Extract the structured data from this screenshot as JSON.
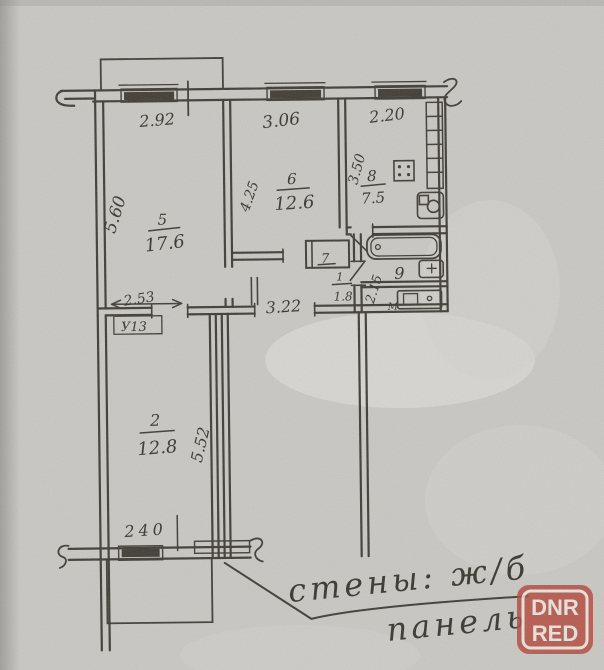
{
  "plan": {
    "dims": {
      "window_left": "2.92",
      "window_middle": "3.06",
      "window_kitchen": "2.20",
      "room5_depth": "5.60",
      "room6_depth": "4.25",
      "kitchen_depth": "3.50",
      "corridor_length": "3.22",
      "corridor_depth": "2.15",
      "room5_opening": "2.53",
      "opening_mark": "У13",
      "room2_depth": "5.52",
      "room2_width": "240"
    },
    "rooms": {
      "r5": {
        "number": "5",
        "area": "17.6"
      },
      "r6": {
        "number": "6",
        "area": "12.6"
      },
      "r7": {
        "number": "7"
      },
      "r8": {
        "number": "8",
        "area": "7.5"
      },
      "r9": {
        "number": "9"
      },
      "r1": {
        "number": "1",
        "area": "1.8"
      },
      "r2": {
        "number": "2",
        "area": "12.8"
      }
    },
    "marks": {
      "bath_m": "М"
    },
    "note": {
      "line1": "стены: ж/б",
      "line2": "панель"
    }
  },
  "watermark": {
    "line1": "DNR",
    "line2": "RED"
  }
}
